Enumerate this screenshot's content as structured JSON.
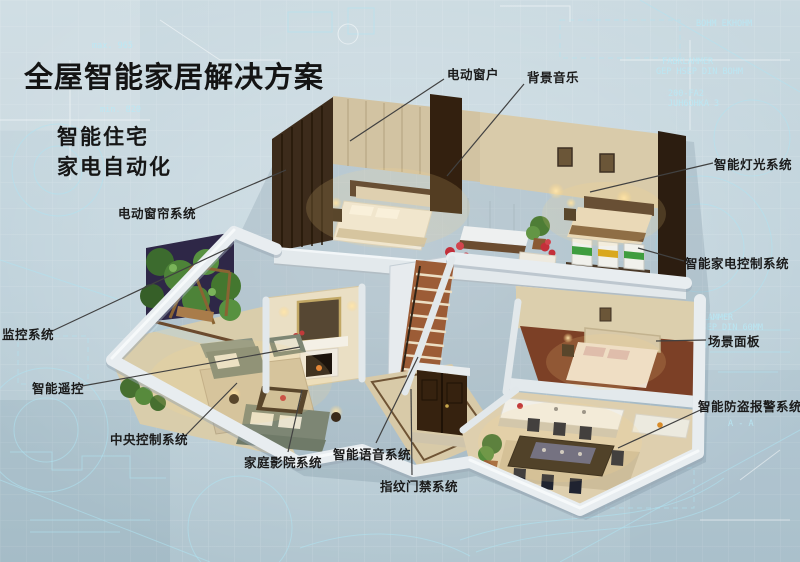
{
  "header": {
    "title": "全屋智能家居解决方案",
    "subtitle_line1": "智能住宅",
    "subtitle_line2": "家电自动化"
  },
  "callouts": [
    {
      "id": "electric-window",
      "label": "电动窗户"
    },
    {
      "id": "background-music",
      "label": "背景音乐"
    },
    {
      "id": "smart-lighting",
      "label": "智能灯光系统"
    },
    {
      "id": "appliance-control",
      "label": "智能家电控制系统"
    },
    {
      "id": "scene-panel",
      "label": "场景面板"
    },
    {
      "id": "burglar-alarm",
      "label": "智能防盗报警系统"
    },
    {
      "id": "monitoring",
      "label": "监控系统"
    },
    {
      "id": "smart-remote",
      "label": "智能遥控"
    },
    {
      "id": "electric-curtain",
      "label": "电动窗帘系统"
    },
    {
      "id": "central-control",
      "label": "中央控制系统"
    },
    {
      "id": "home-theater",
      "label": "家庭影院系统"
    },
    {
      "id": "voice-system",
      "label": "智能语音系统"
    },
    {
      "id": "fingerprint-access",
      "label": "指纹门禁系统"
    }
  ],
  "background": {
    "texts": [
      "max. 965",
      "min. 820",
      "BOHM EKHOHM",
      "FABKLAMMER",
      "GEP HSEP DIN BOHM",
      "200-FA2",
      "JUH6OHKA 3",
      "FABKLAMMER",
      "GEP HSEP DIN 60MM",
      "200-FA2",
      "A - A"
    ]
  },
  "colors": {
    "canvas": "#bfd1da",
    "blueprint_line": "#aee4f2",
    "label_text": "#1b1b1b",
    "leader_line": "#414141",
    "wall_cap": "#e8edf0",
    "warm_floor": "#d9cdab",
    "dark_wood": "#3c2b1b"
  }
}
